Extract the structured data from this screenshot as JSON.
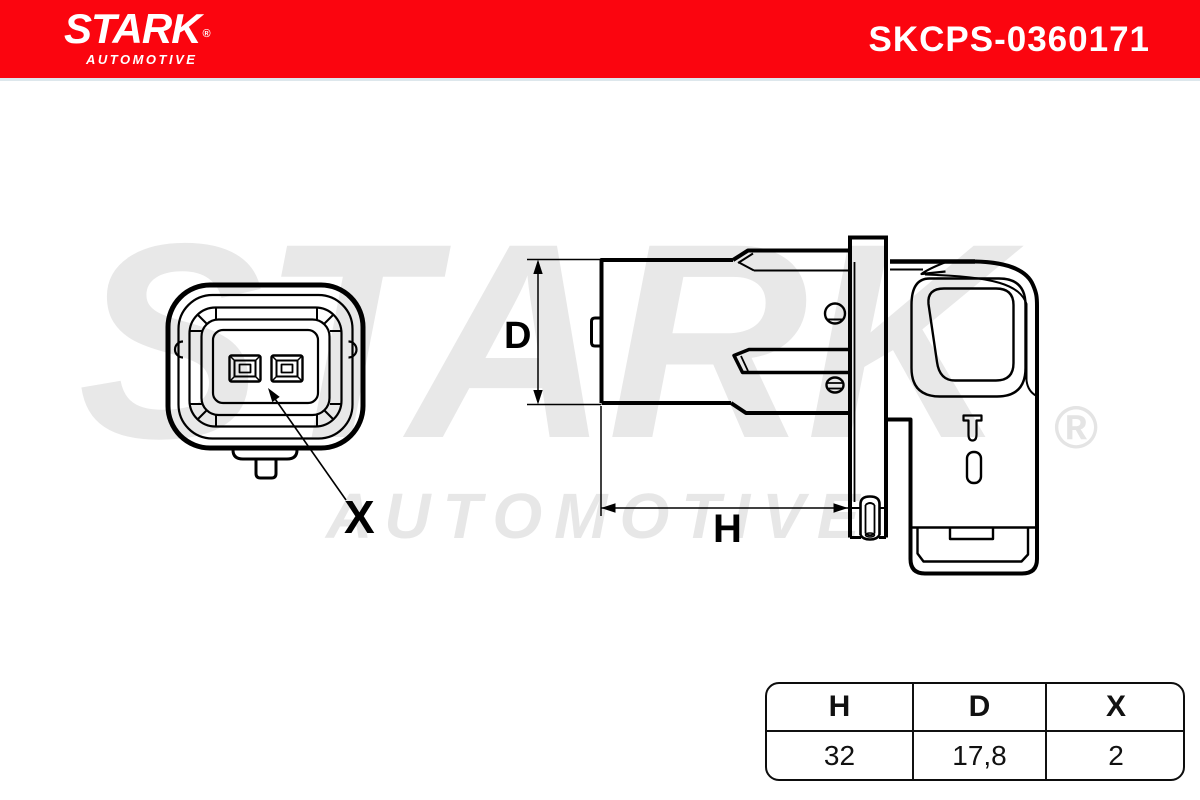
{
  "header": {
    "brand": "STARK",
    "brand_reg": "®",
    "brand_sub": "AUTOMOTIVE",
    "part_number": "SKCPS-0360171",
    "bg_color": "#fb050f"
  },
  "watermark": {
    "brand": "STARK",
    "reg": "®",
    "sub": "AUTOMOTIVE",
    "color": "#e8e8e8"
  },
  "drawing": {
    "x_label": "X",
    "d_label": "D",
    "h_label": "H"
  },
  "table": {
    "columns": [
      {
        "label": "H",
        "value": "32"
      },
      {
        "label": "D",
        "value": "17,8"
      },
      {
        "label": "X",
        "value": "2"
      }
    ]
  }
}
